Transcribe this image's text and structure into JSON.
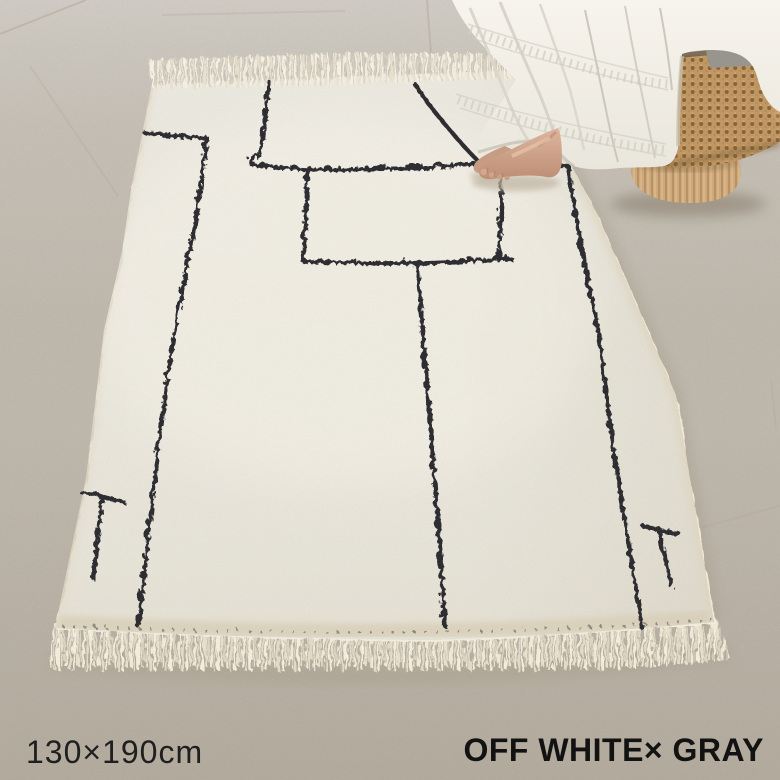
{
  "caption": {
    "size": "130×190cm",
    "colorway": "OFF WHITE× GRAY"
  },
  "colors": {
    "floor": "#ccc5b9",
    "floor_far": "#dad5cc",
    "floor_near": "#c1b8aa",
    "rug": "#f1ebdc",
    "rug_shade": "#ddd4bf",
    "fringe": "#efe8d6",
    "pattern_line": "#2e2d31",
    "dress": "#f4f1e9",
    "dress_fold": "#d8d4c9",
    "skin": "#d2a98e",
    "basket_cane": "#c09763",
    "basket_hole": "#77572f",
    "basket_base": "#cda97c",
    "cushion": "#97958e",
    "caption_text": "#1c1c1c"
  }
}
